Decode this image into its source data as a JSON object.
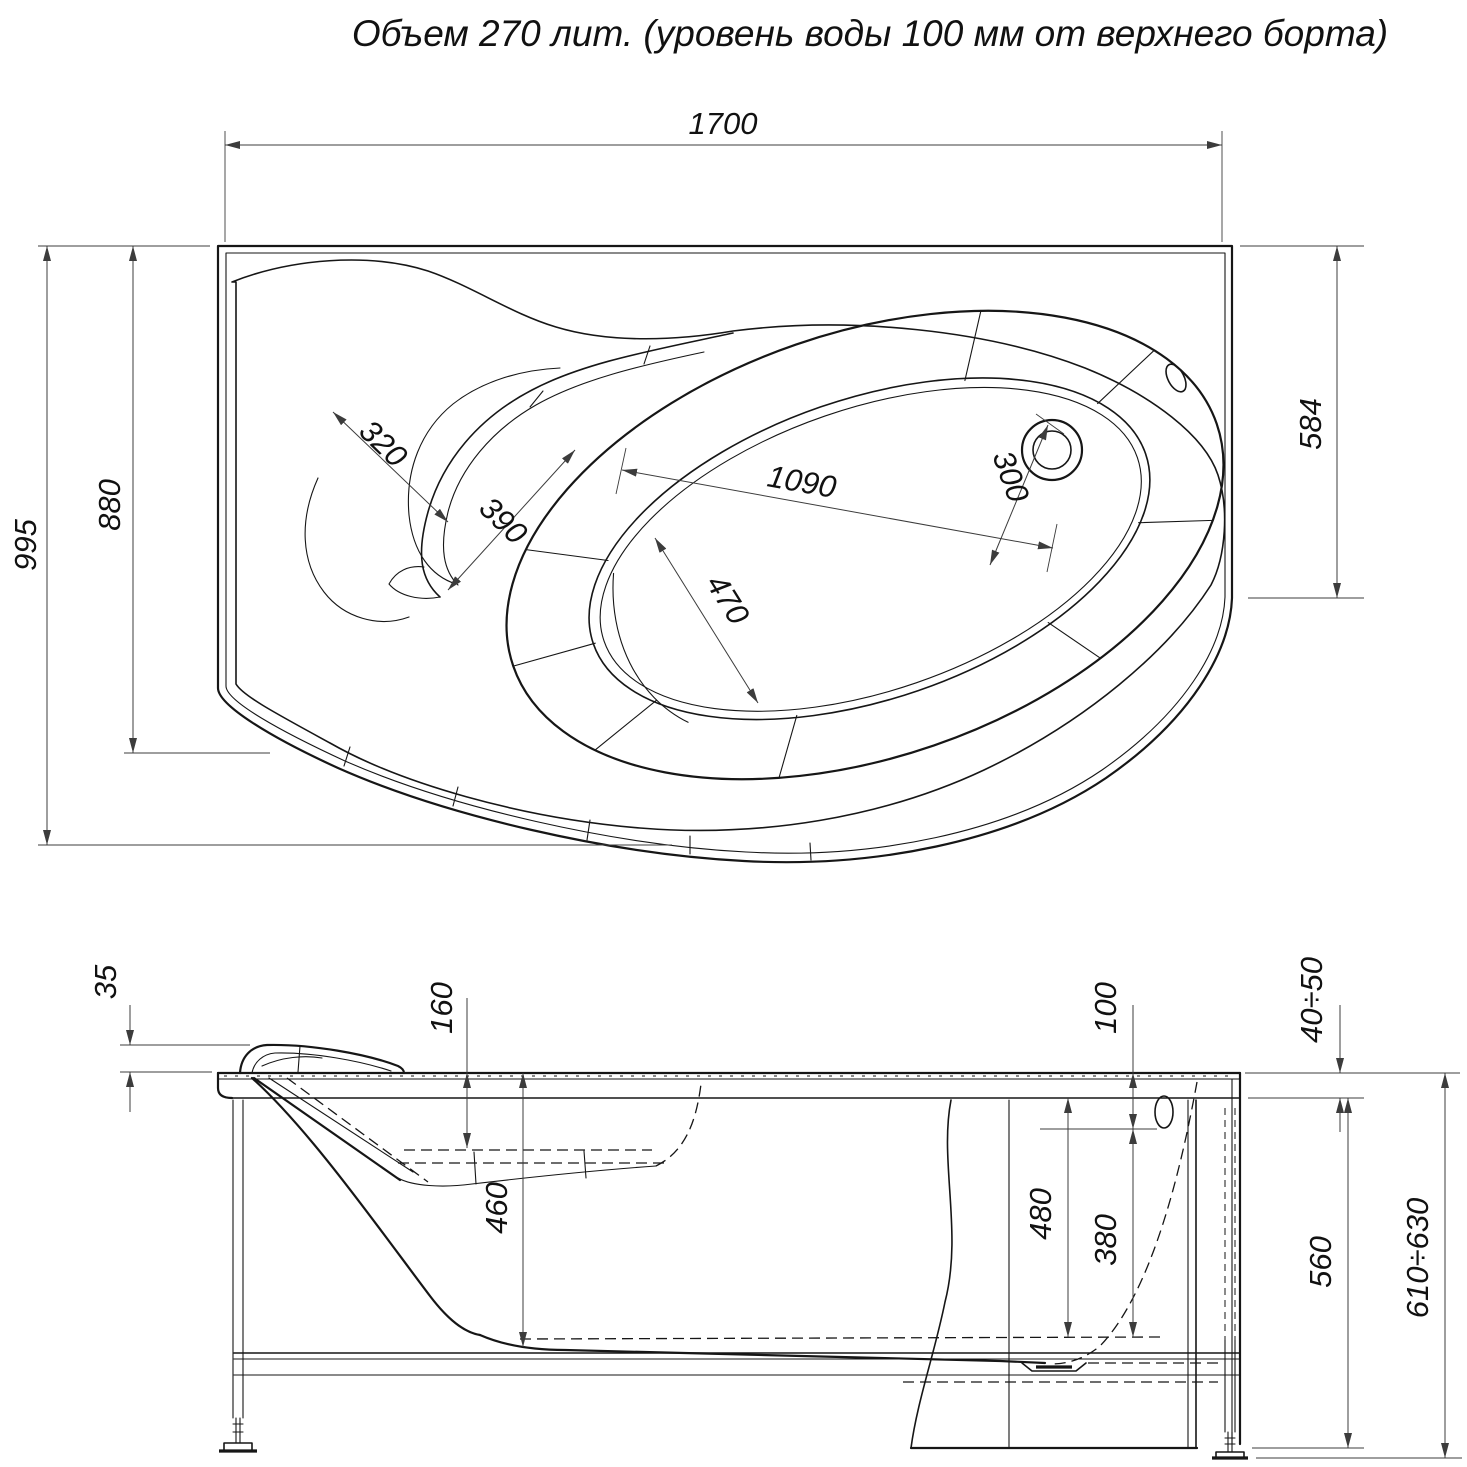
{
  "title": "Объем 270 лит. (уровень воды 100 мм от верхнего борта)",
  "top_view": {
    "dims": {
      "d1700": "1700",
      "d995": "995",
      "d880": "880",
      "d584": "584",
      "d320": "320",
      "d390": "390",
      "d1090": "1090",
      "d470": "470",
      "d300": "300"
    }
  },
  "side_view": {
    "dims": {
      "d35": "35",
      "d160": "160",
      "d460": "460",
      "d100": "100",
      "d40_50": "40÷50",
      "d480": "480",
      "d380": "380",
      "d560": "560",
      "d610_630": "610÷630"
    }
  },
  "colors": {
    "outline": "#161616",
    "dimension": "#3c3c3c",
    "background": "#ffffff"
  }
}
